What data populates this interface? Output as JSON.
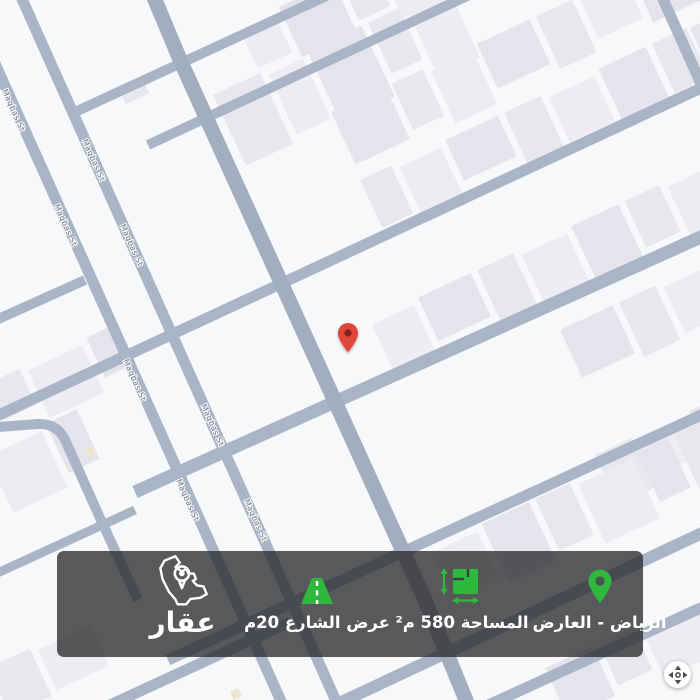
{
  "map": {
    "street_labels": [
      "Maqbas St",
      "Maqbas St",
      "Maqbas St",
      "Maqbas St",
      "Maqbas St",
      "Maqbas St",
      "Maqbas St",
      "Maqbas St"
    ],
    "marker": {
      "type": "property-location-pin",
      "color": "#e0443a"
    },
    "colors": {
      "background": "#f7f8fa",
      "building": "#e8e7ee",
      "street": "#a9b4c6",
      "accent_green": "#2eb83c",
      "bar_background": "rgba(44,44,46,0.78)"
    }
  },
  "info_bar": {
    "location": {
      "icon": "location-pin-icon",
      "label": "الرياض - العارض"
    },
    "area": {
      "icon": "area-dimensions-icon",
      "label": "المساحة 580 م²"
    },
    "street_width": {
      "icon": "road-icon",
      "label": "عرض الشارع 20م"
    },
    "logo": {
      "icon": "saudi-arabia-map-pin-icon",
      "wordmark": "عقار"
    }
  },
  "controls": {
    "pan": "pan-arrows-icon"
  }
}
